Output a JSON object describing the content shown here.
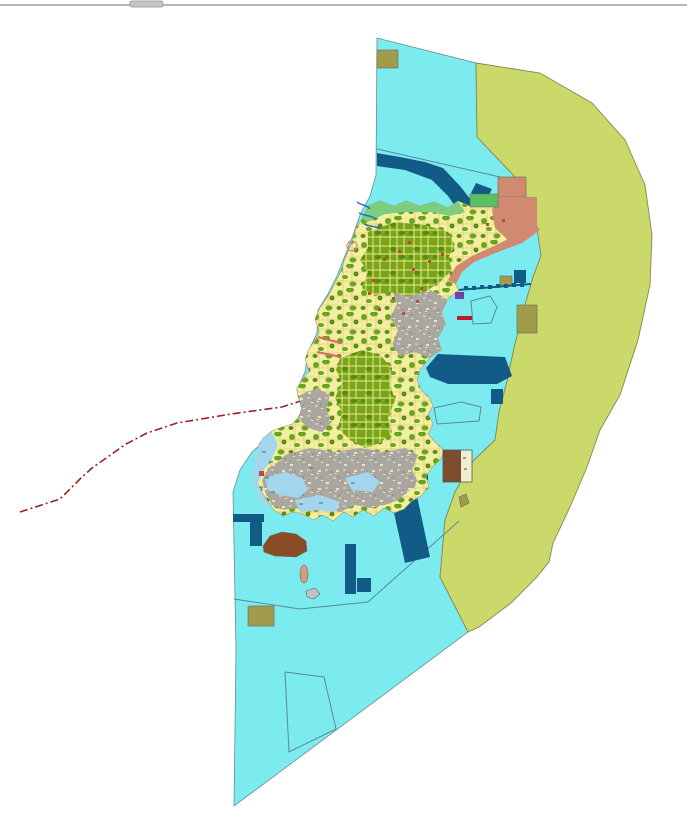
{
  "map": {
    "type": "gis-land-use-map",
    "features": {
      "water_zone": "coastal-water-area",
      "buffer_zone": "eastern-buffer-zone",
      "island": "central-island-landuse-mosaic",
      "boundary_line": "dashed-red-municipal-boundary",
      "piers": "harbor-and-pier-structures",
      "lagoons": "west-coast-shallow-lagoons"
    }
  },
  "palette": {
    "background": "#ffffff",
    "water": "#7cebef",
    "buffer_zone": "#cbd96b",
    "lagoon": "#a3d6ec",
    "island_base": "#f4efa0",
    "forest": "#66a61e",
    "forest_dark": "#568c12",
    "forest_dense": "#76a517",
    "forest_vein": "#efe68e",
    "parcel_line": "#d9bc72",
    "urban": "#aba7a0",
    "urban_fleck1": "#c9c5bb",
    "urban_fleck2": "#8d99a1",
    "urban_fleck3": "#e7e3c6",
    "urban_fleck4": "#98b39e",
    "shore_green": "#7ecc7e",
    "salmon": "#d08a72",
    "harbor_blue": "#115b86",
    "khaki": "#a29b4c",
    "brown": "#8a4b26",
    "dark_brown": "#7b4f2e",
    "cream": "#f0edd0",
    "green_parcel": "#5cbe63",
    "boundary_red": "#9b2222",
    "road_pink": "#e06070",
    "stream_blue": "#2565c8",
    "village_red": "#be4a3c",
    "pier_red": "#c01830",
    "purple": "#7a3fa0",
    "islet_gray": "#bfc3c6",
    "islet_pink": "#d89b85",
    "edge_line_gray": "#9b9f9f",
    "knob_gray": "#c4c8c4",
    "mark_black": "#222222",
    "circle_pink": "#cc8888"
  }
}
